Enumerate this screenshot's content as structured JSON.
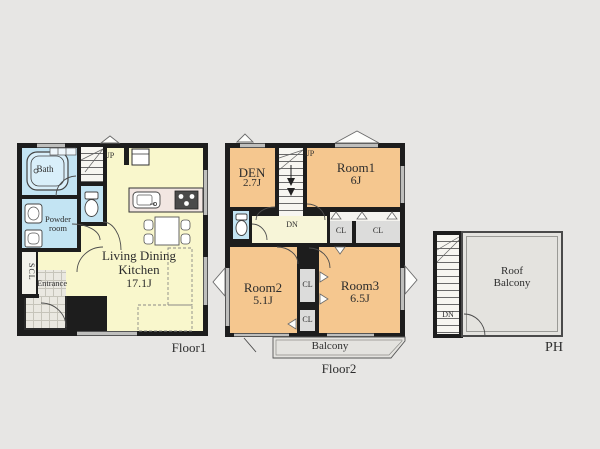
{
  "colors": {
    "background": "#e7e6e4",
    "wall": "#1d1d1d",
    "ldk": "#f9f7cc",
    "room": "#f5c78f",
    "wet": "#c3e4f3",
    "hall": "#f7f5d8",
    "closet": "#dcdcdb",
    "tile": "#eae8e1",
    "balcony": "#e4e3df",
    "counter": "#f2e6e2",
    "text": "#2d2d2d"
  },
  "floor1": {
    "label": "Floor1",
    "ldk_name": "Living Dining\nKitchen",
    "ldk_size": "17.1J",
    "bath": "Bath",
    "powder_room": "Powder\nroom",
    "scl": "SCL",
    "entrance": "Entrance",
    "up": "UP"
  },
  "floor2": {
    "label": "Floor2",
    "den_name": "DEN",
    "den_size": "2.7J",
    "room1_name": "Room1",
    "room1_size": "6J",
    "room2_name": "Room2",
    "room2_size": "5.1J",
    "room3_name": "Room3",
    "room3_size": "6.5J",
    "closet": "CL",
    "balcony": "Balcony",
    "up": "UP",
    "dn": "DN"
  },
  "ph": {
    "label": "PH",
    "roof_balcony": "Roof\nBalcony",
    "dn": "DN"
  }
}
